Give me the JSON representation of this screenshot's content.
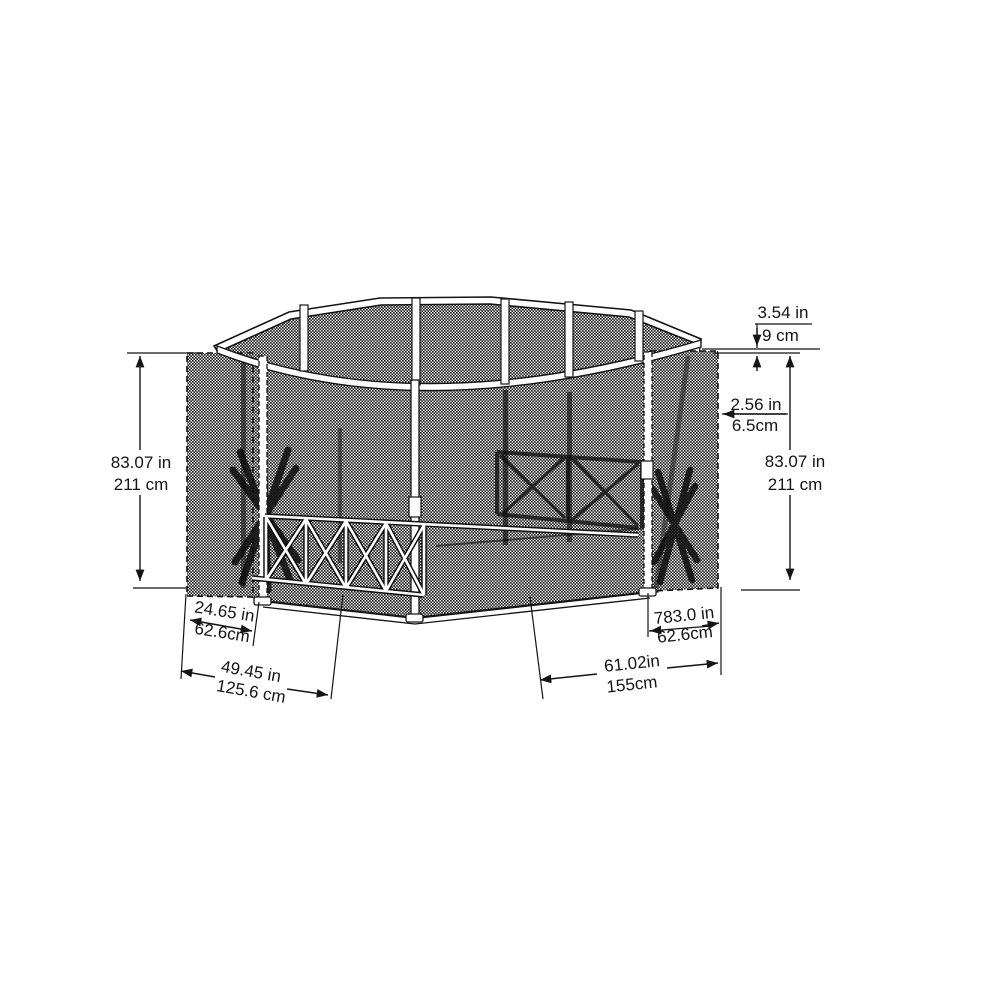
{
  "diagram": {
    "name": "pop-up screen house dimension diagram",
    "background": "#ffffff",
    "line_color": "#141414",
    "mesh_color": "#161616",
    "dims": {
      "top_rail": {
        "in": "3.54 in",
        "cm": "9 cm"
      },
      "frame": {
        "in": "2.56 in",
        "cm": "6.5cm"
      },
      "height_left": {
        "in": "83.07 in",
        "cm": "211 cm"
      },
      "height_right": {
        "in": "83.07 in",
        "cm": "211 cm"
      },
      "side_left": {
        "in": "24.65 in",
        "cm": "62.6cm"
      },
      "front_left": {
        "in": "49.45 in",
        "cm": "125.6 cm"
      },
      "front_right": {
        "in": "61.02in",
        "cm": "155cm"
      },
      "side_right": {
        "in": "783.0 in",
        "cm": "62.6cm"
      }
    }
  }
}
